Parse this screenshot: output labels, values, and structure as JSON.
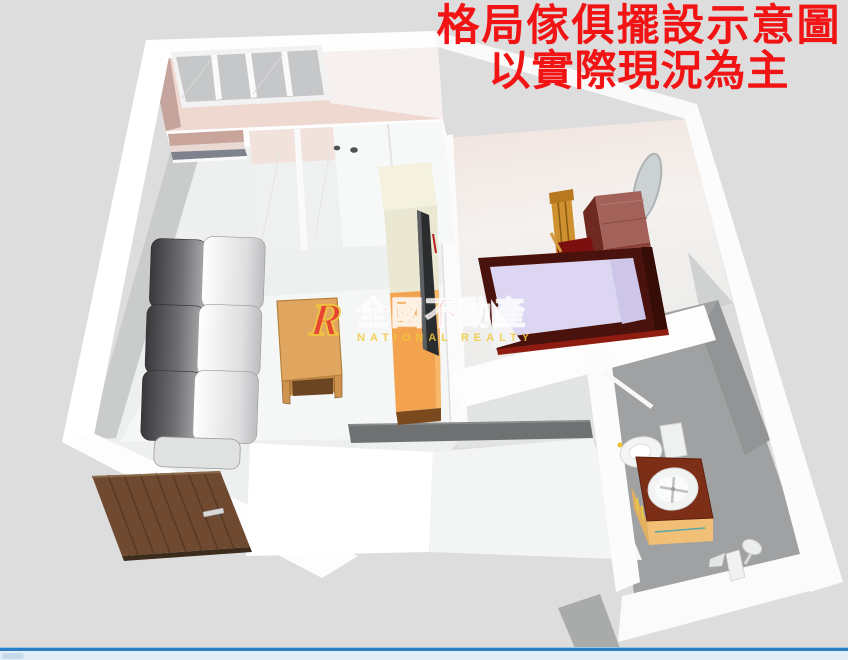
{
  "title": {
    "line1": "格局傢俱擺設示意圖",
    "line2": "以實際現況為主"
  },
  "watermark": {
    "logo_letter": "R",
    "brand": "全國不動產",
    "subtitle": "NATIONAL REALTY"
  },
  "scene": {
    "type": "3d-floorplan-render",
    "rooms": [
      "balcony",
      "living-room",
      "bedroom",
      "bathroom",
      "entry"
    ]
  },
  "colors": {
    "background": "#dcdddc",
    "title_red": "#f21414",
    "brand_red": "#e8362b",
    "brand_gold": "#f0c83c",
    "wall": "#fdfdfd",
    "balcony_floor": "#eed8cf",
    "bedroom_floor": "#f3efec",
    "living_floor": "#eef0f0",
    "bathroom_floor": "#9fa1a2",
    "sofa_dark": "#46464a",
    "sofa_light": "#e8e9e9",
    "wood_table": "#e0a55f",
    "cream_cabinet": "#f4f1de",
    "orange_cabinet": "#f3a24d",
    "tv_panel": "#2b2c2e",
    "bed_mattress": "#dcd6f2",
    "bed_frame": "#4a120c",
    "dresser": "#a2625a",
    "chair_wood": "#cf9030",
    "door_wood": "#6f4a31",
    "vanity_top": "#7c2e16",
    "vanity_cabinet": "#f1bf75",
    "counter": "#6f7172",
    "status_bar_blue": "#2a7fc4",
    "status_bar_light": "#e2ecf4"
  }
}
